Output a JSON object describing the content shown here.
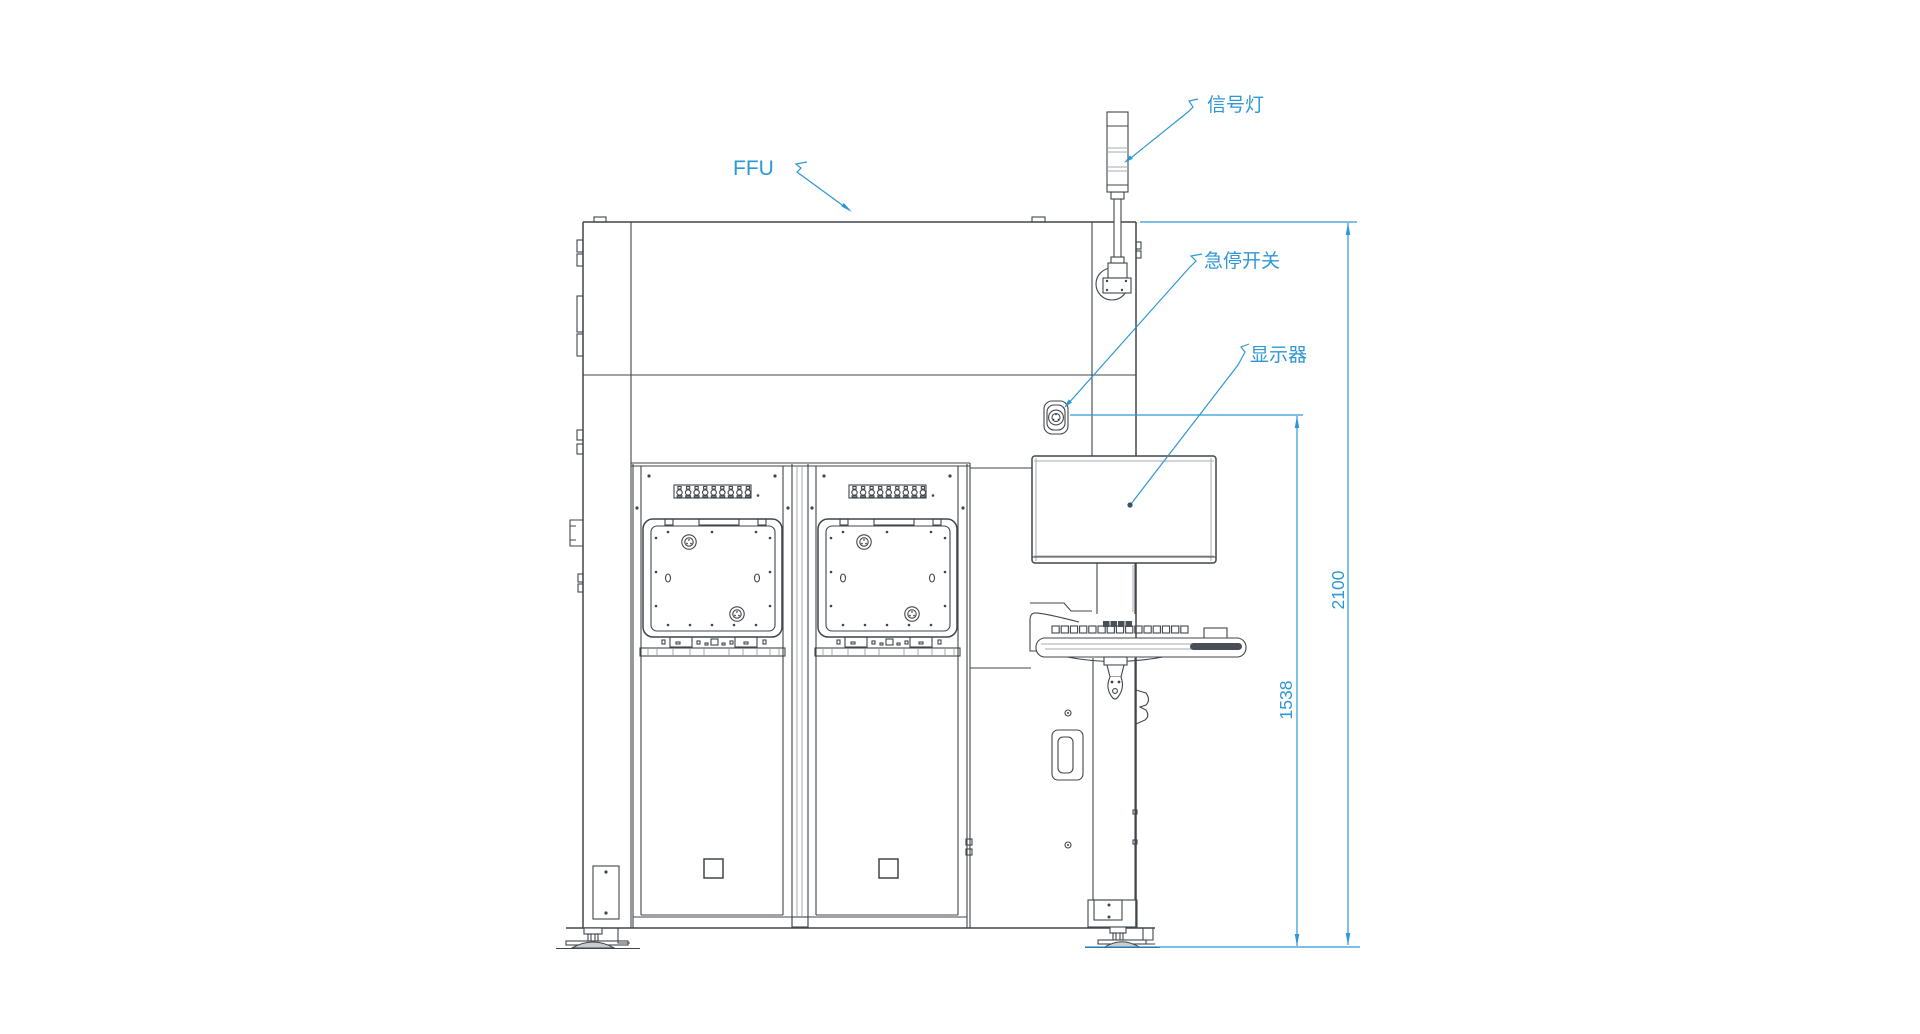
{
  "labels": {
    "ffu": "FFU",
    "signal_light": "信号灯",
    "emergency_stop": "急停开关",
    "monitor": "显示器"
  },
  "dimensions": {
    "total_height": "2100",
    "operator_height": "1538"
  },
  "colors": {
    "annotation_blue": "#2e97d4",
    "drawing_dark": "#41464c",
    "drawing_light": "#a6abb0",
    "background": "#ffffff"
  }
}
